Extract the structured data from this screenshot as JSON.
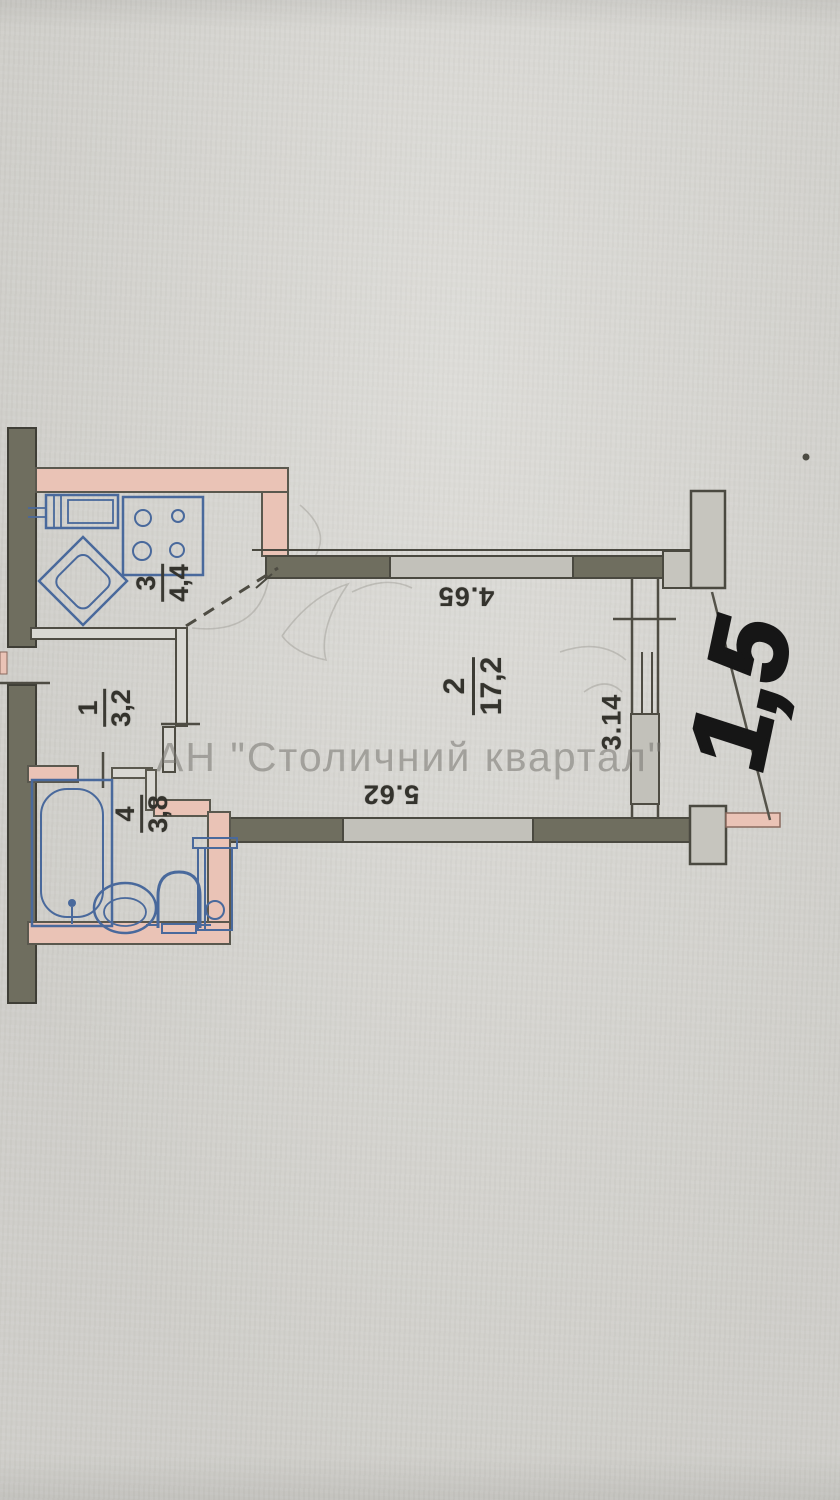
{
  "watermark": {
    "text": "АН \"Столичний квартал\""
  },
  "rooms": [
    {
      "number": "3",
      "area": "4,4"
    },
    {
      "number": "1",
      "area": "3,2"
    },
    {
      "number": "4",
      "area": "3,8"
    },
    {
      "number": "2",
      "area": "17,2"
    }
  ],
  "dimensions": {
    "top": "4.65",
    "bottom": "5.62",
    "right": "3.14"
  },
  "annotation": {
    "handwritten": "1,5"
  },
  "colors": {
    "paper": "#d7d6d1",
    "wall_dark": "#6f6e5f",
    "wall_light": "#c2c1ba",
    "wall_salmon": "#eac3b6",
    "line": "#4e4c43",
    "fixture_blue": "#49699c",
    "handwriting": "#161616",
    "watermark_gray": "#767470"
  }
}
